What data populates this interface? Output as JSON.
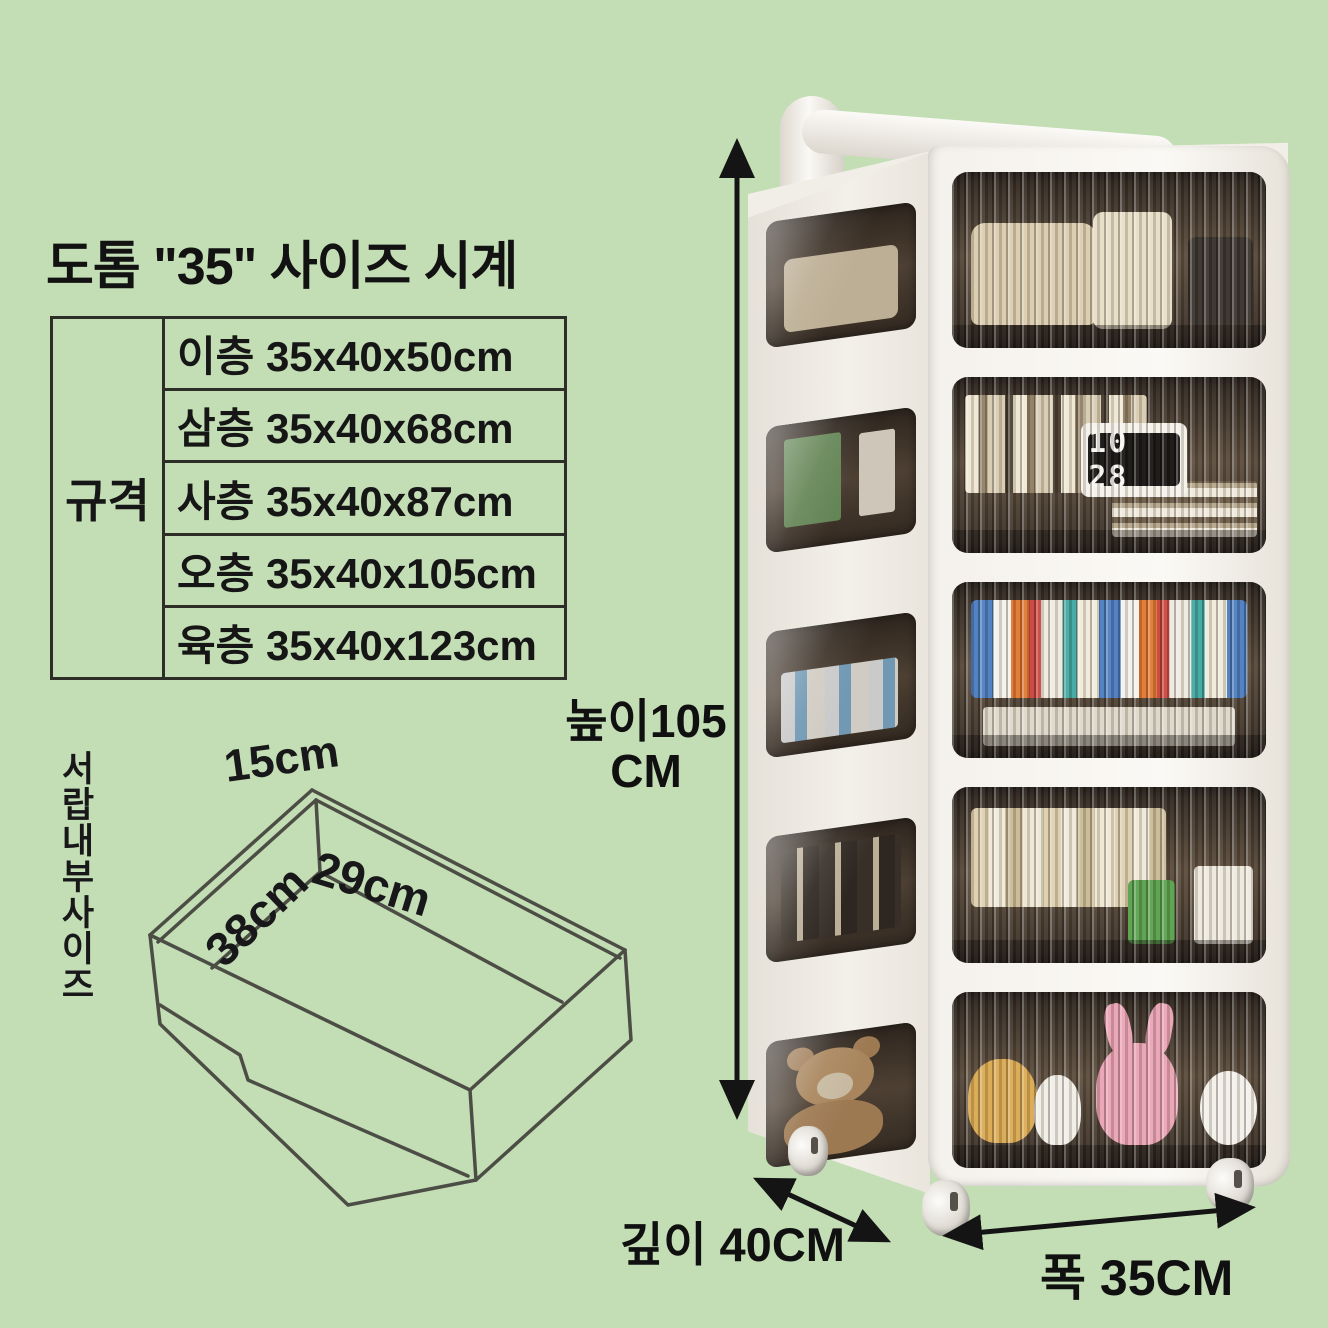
{
  "title": "도톰 \"35\" 사이즈 시계",
  "spec_table": {
    "row_header": "규격",
    "rows": [
      "이층 35x40x50cm",
      "삼층 35x40x68cm",
      "사층 35x40x87cm",
      "오층 35x40x105cm",
      "육층 35x40x123cm"
    ]
  },
  "drawer_diagram": {
    "side_caption": "서랍내부사이즈",
    "top_dim": "15cm",
    "width_dim": "29cm",
    "depth_dim": "38cm"
  },
  "dimensions": {
    "height": "높이105",
    "height_unit": "CM",
    "depth": "깊이 40CM",
    "width": "폭 35CM"
  },
  "cart": {
    "tier_count": 5,
    "clock": "10 28"
  },
  "colors": {
    "background": "#c3ddb4",
    "line_art": "#4c4d45",
    "arrow": "#141414",
    "cart_body": "#f6f4ef",
    "door_interior": "#5c4d3d"
  }
}
